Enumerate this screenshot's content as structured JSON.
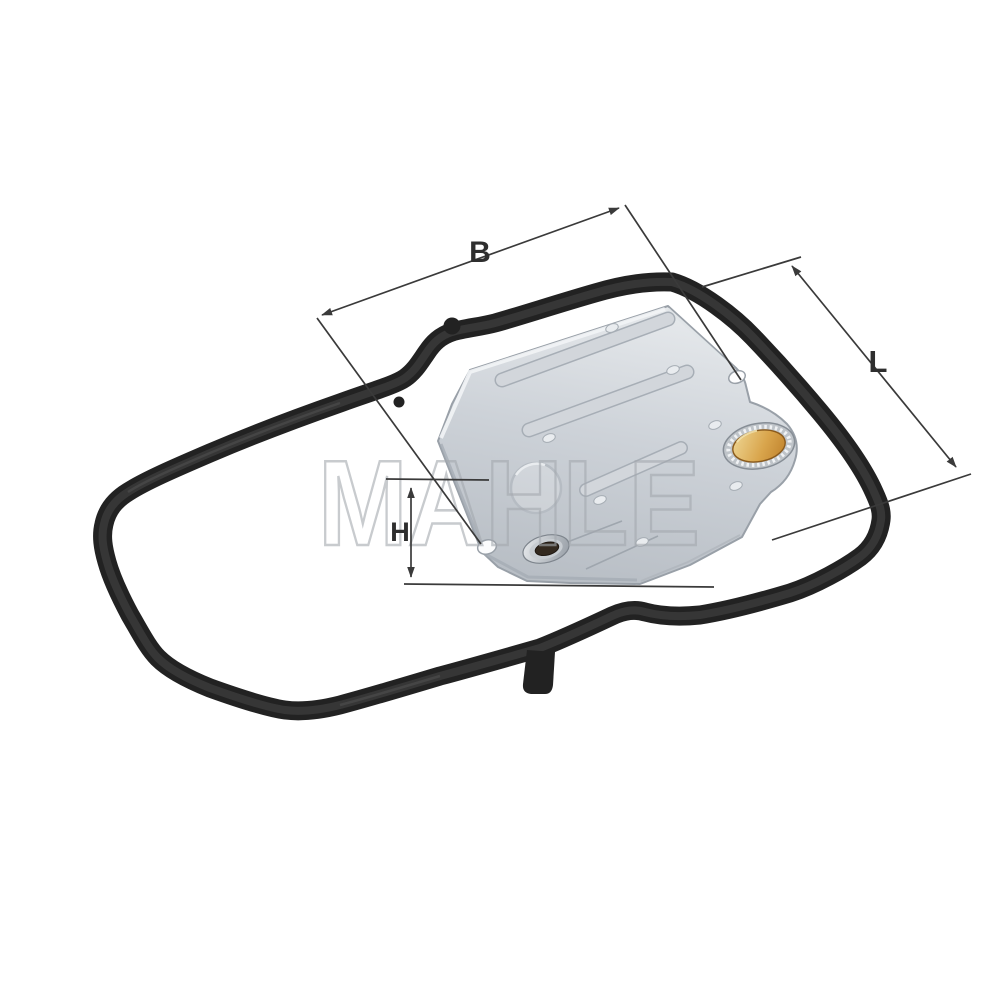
{
  "image": {
    "type": "product-photo",
    "subject": "automatic transmission hydraulic filter set with pan gasket",
    "background": "#ffffff"
  },
  "watermark": {
    "text": "MAHLE",
    "color": "#a4a9af"
  },
  "dimension_labels": {
    "b": "B",
    "l": "L",
    "h": "H"
  },
  "parts": {
    "gasket": "pan-gasket",
    "filter_pan": "hydraulic-filter-pan",
    "seal_ring": "filler-seal-ring",
    "collar_hole": "intake-collar-hole"
  },
  "colors": {
    "gasket": "#222222",
    "pan_light": "#e6e9ec",
    "pan_dark": "#b9bfc6",
    "seal_orange": "#d9a54c",
    "dimension_line": "#3a3a3a",
    "label_text": "#2e2e2e",
    "watermark": "#a4a9af"
  }
}
